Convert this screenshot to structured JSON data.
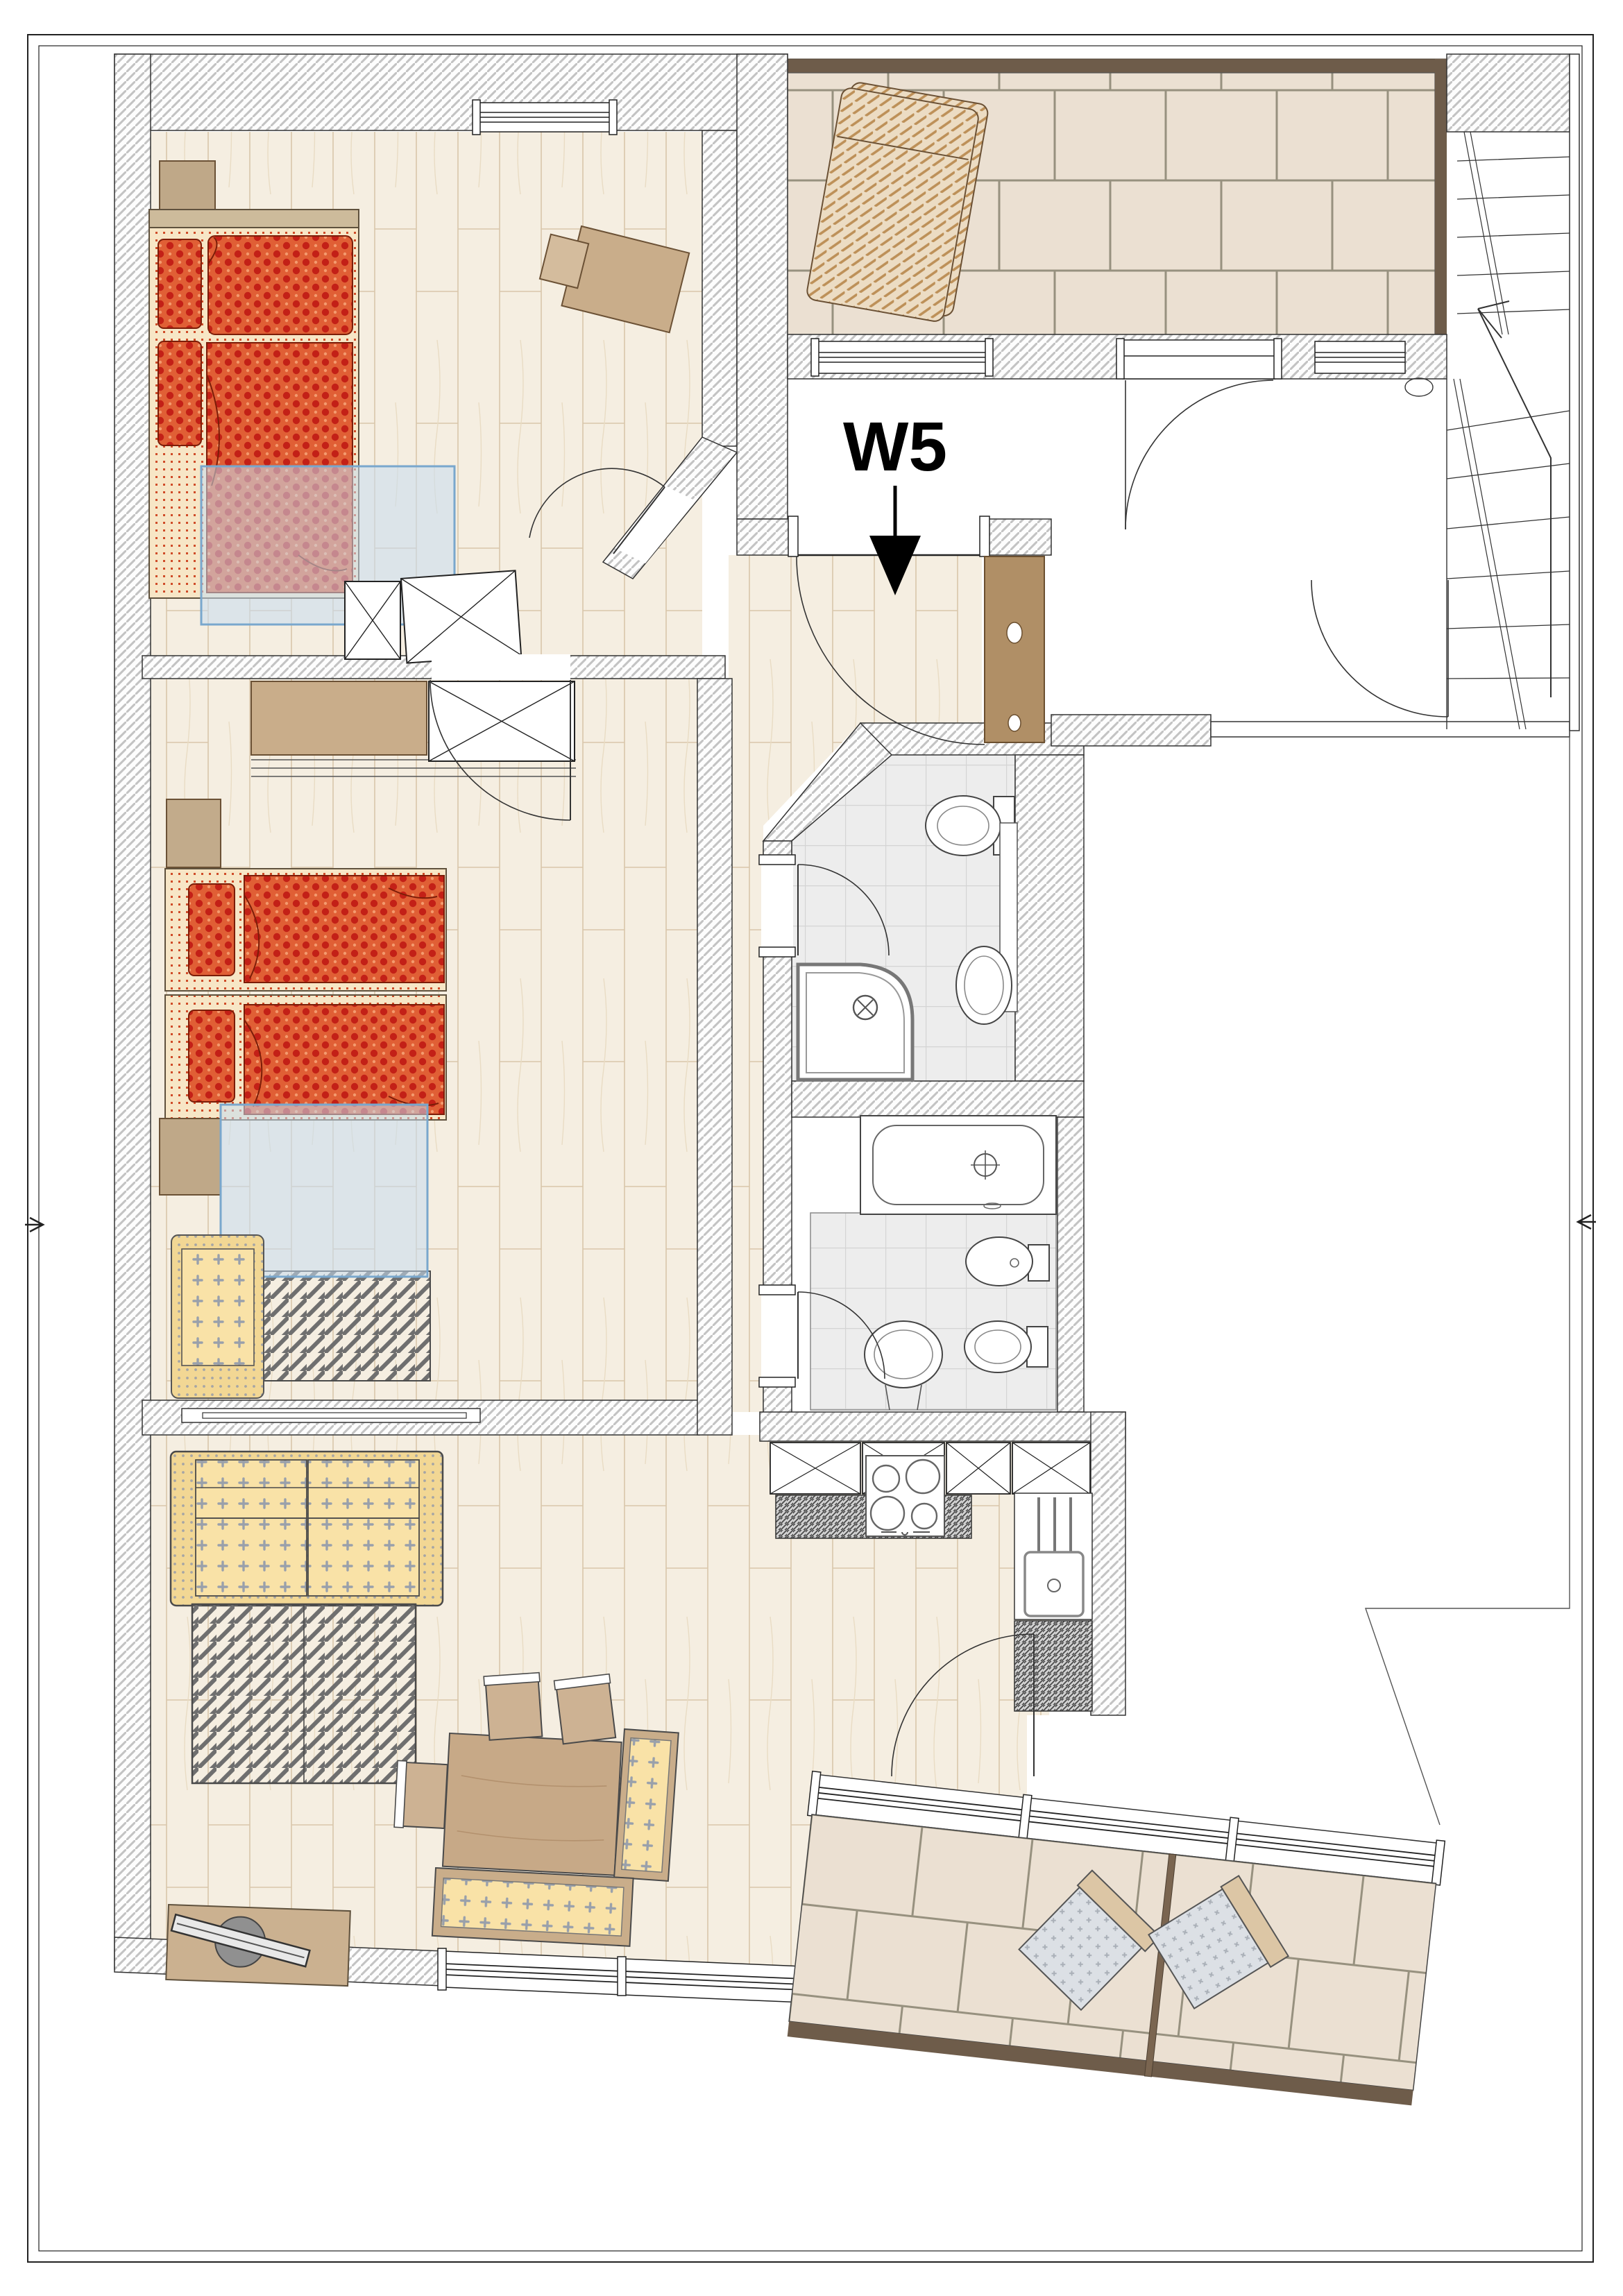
{
  "plan": {
    "unit_label": "W5",
    "drawing_type": "apartment-floor-plan",
    "rooms": [
      {
        "name": "bedroom-1"
      },
      {
        "name": "bedroom-2"
      },
      {
        "name": "hallway"
      },
      {
        "name": "shower-wc"
      },
      {
        "name": "bathroom"
      },
      {
        "name": "kitchen"
      },
      {
        "name": "living-dining-room"
      },
      {
        "name": "terrace-top"
      },
      {
        "name": "balcony-bottom"
      },
      {
        "name": "stairwell"
      },
      {
        "name": "corridor-landing"
      }
    ],
    "icons": [
      {
        "name": "entry-arrow-icon"
      },
      {
        "name": "stair-direction-arrow-icon"
      },
      {
        "name": "section-arrow-left-icon"
      },
      {
        "name": "section-arrow-right-icon"
      }
    ]
  },
  "palette": {
    "outline": "#3a3a3a",
    "wall-hatch-line": "#c3c3c3",
    "wood-floor": "#f5eee1",
    "wood-line": "#d9c6aa",
    "wood-grain": "#e9dcc4",
    "tile-beige": "#ebe0d2",
    "tile-grout": "#97917f",
    "tile-gray": "#ededed",
    "tile-gray-line": "#d4d4d4",
    "bed-red": "#e05f35",
    "bed-red-dark": "#c32017",
    "bed-red-edge": "#7c1d08",
    "mattress-cream": "#f7e6c6",
    "fabric-yellow": "#f9e2a7",
    "fabric-yellow-deep": "#f2d794",
    "fabric-mark": "#99a0ab",
    "wood-furniture": "#c9ad8a",
    "wood-furniture-dark": "#6b5135",
    "door-wood": "#b08f66",
    "glass-blue-border": "#79a7cd",
    "glass-blue-fill": "rgba(199,221,241,0.55)",
    "counter-dark": "#4a4a4a",
    "terrace-edge-brown": "#6e5c4a",
    "rug-line": "#6f6f6f"
  }
}
